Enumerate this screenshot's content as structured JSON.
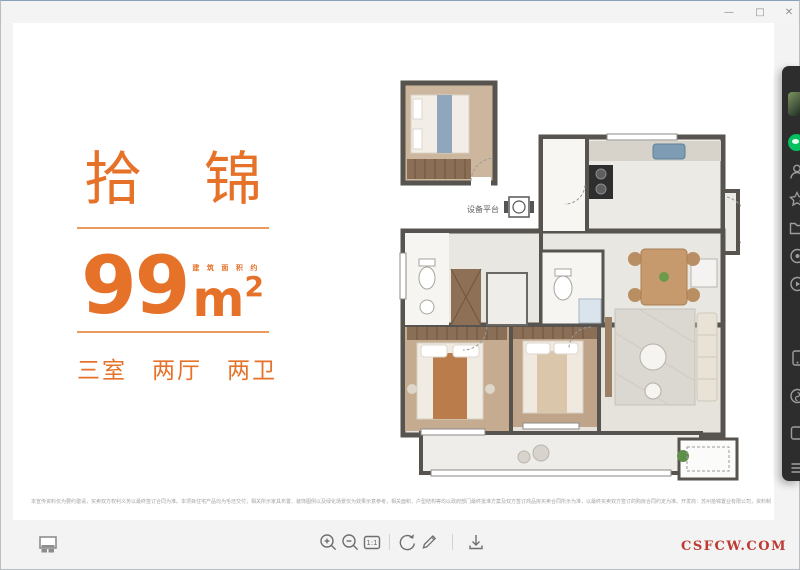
{
  "window": {
    "controls": {
      "minimize": "—",
      "maximize": "□",
      "close": "✕"
    }
  },
  "poster": {
    "name": "拾锦",
    "area_value": "99",
    "area_unit": "m",
    "area_exponent": "2",
    "area_note": "建筑面积约",
    "rooms_summary": "三室　两厅　两卫",
    "accent_color": "#e6722a"
  },
  "floorplan": {
    "equipment_label": "设备平台"
  },
  "viewer_toolbar": {
    "one_to_one_label": "1:1",
    "icons": [
      "thumbnail-view",
      "zoom-in",
      "zoom-out",
      "one-to-one",
      "rotate-clockwise",
      "edit-pencil",
      "download"
    ]
  },
  "brand": {
    "site_label": "CSFCW.COM",
    "color": "#bc3a31"
  },
  "disclaimer": "本宣传资料仅为要约邀请，买卖双方权利义务以最终签订合同为准。本项目住宅产品均为毛坯交付，相关所示家具布置、装饰图例以及绿化场景仅为效果示意参考，相关面积、户型结构等均以政府部门最终批准方案及双方签订商品房买卖合同所示为准，以最终买卖双方签订的购房合同约定为准。开发商：苏州拾锦置业有限公司，资料制作时间2021年7月。",
  "dock": {
    "bg_color": "#2d2d2d",
    "chat_color": "#07c160",
    "icons": [
      "avatar",
      "wechat-chat",
      "contacts",
      "favorites",
      "chat-files",
      "moments",
      "channels",
      "phone",
      "mini-programs",
      "workspace",
      "more-menu"
    ]
  }
}
